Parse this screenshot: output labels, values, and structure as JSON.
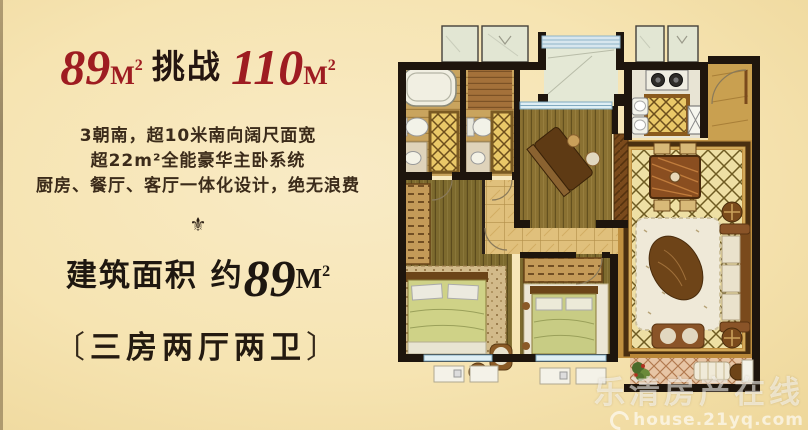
{
  "headline": {
    "num1": "89",
    "unit1": "M²",
    "middle": "挑战",
    "num2": "110",
    "unit2": "M²",
    "accent_color": "#9e1c21"
  },
  "subtitle": {
    "line1": "3朝南，超10米南向阔尺面宽",
    "line2": "超22m²全能豪华主卧系统",
    "line3": "厨房、餐厅、客厅一体化设计，绝无浪费"
  },
  "ornament": {
    "icon": "fleur-de-lis",
    "glyph": "⚜"
  },
  "area": {
    "label": "建筑面积 约",
    "num": "89",
    "unit": "M²"
  },
  "layout_tag": {
    "open": "〔",
    "text": "三房两厅两卫",
    "close": "〕"
  },
  "watermark": {
    "line1": "乐清房产在线",
    "line2": "house.21yq.com"
  },
  "floorplan": {
    "description": "hand-drawn watercolor floor plan, three bedrooms, two halls, two baths",
    "palette": {
      "background": "#f6e4b2",
      "wall": "#1e150d",
      "wood_floor": "#7d6a2e",
      "lattice_floor": "#eedfa4",
      "lattice_line": "#6e5b22",
      "bath_lattice": "#e9c868",
      "balcony_floor": "#e7c5a5",
      "window_blue": "#8fb4c8",
      "niche_green": "#e2e6d3",
      "marble_hall": "#e0c07c",
      "furniture_brown": "#8a5428"
    }
  }
}
